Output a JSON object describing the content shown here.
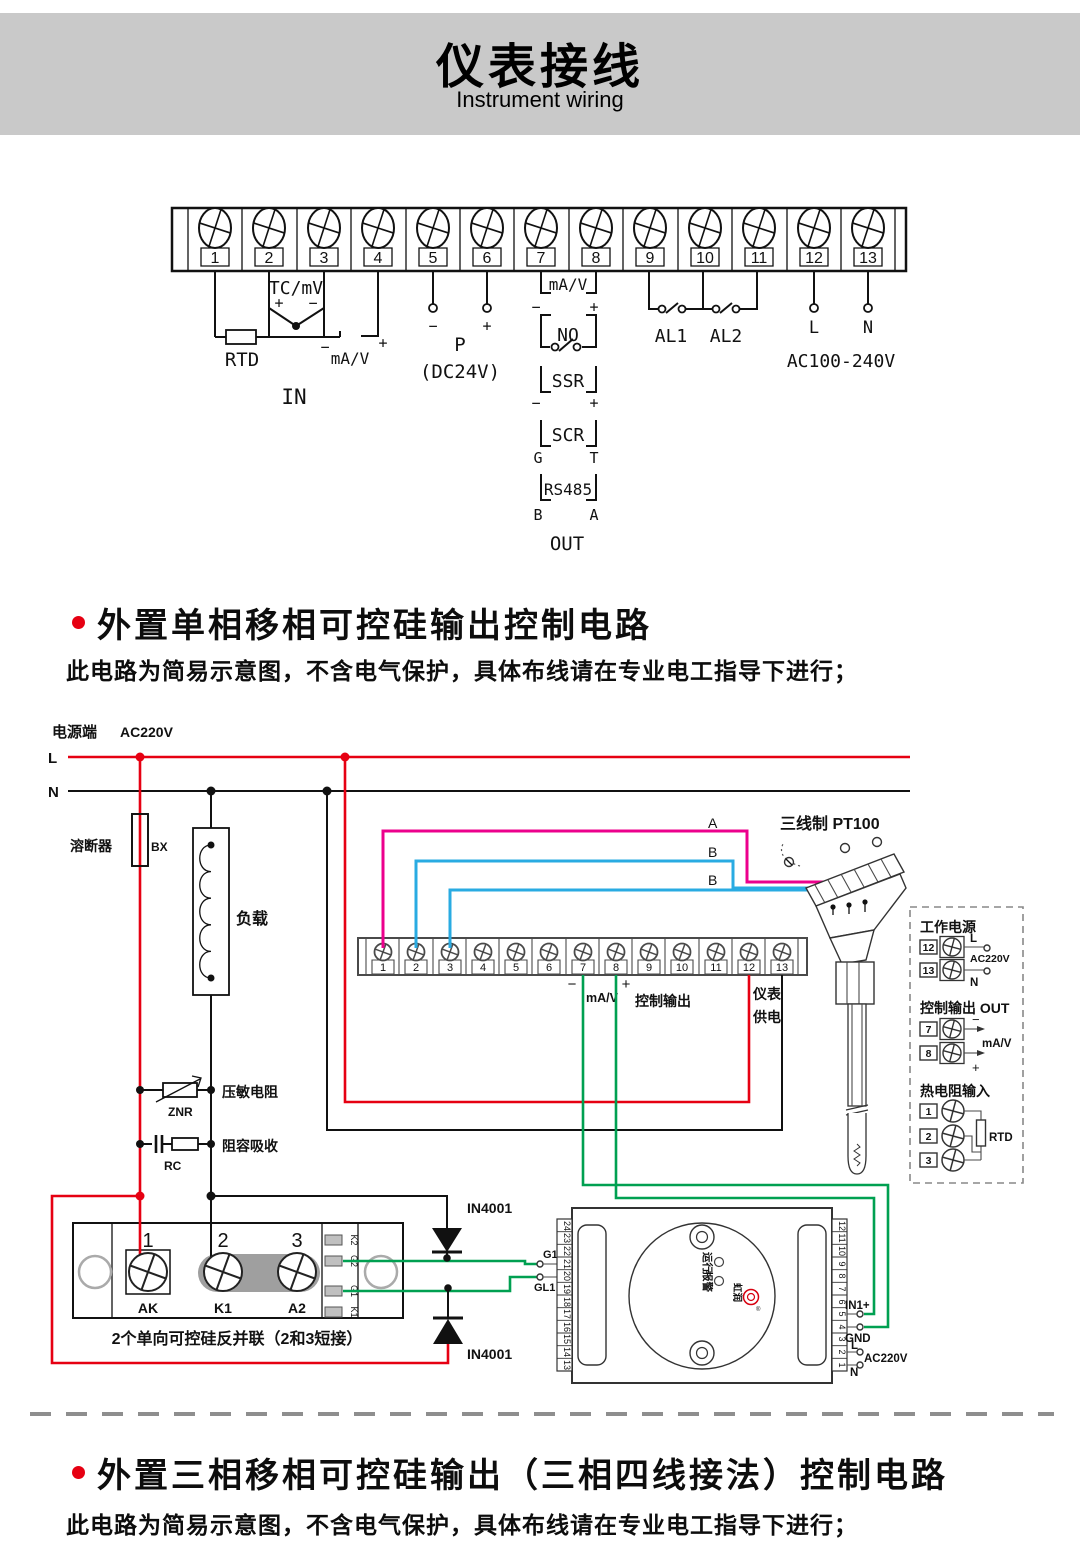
{
  "header": {
    "title": "仪表接线",
    "subtitle": "Instrument wiring"
  },
  "signs": {
    "minus": "−",
    "plus": "+"
  },
  "terminals": [
    "1",
    "2",
    "3",
    "4",
    "5",
    "6",
    "7",
    "8",
    "9",
    "10",
    "11",
    "12",
    "13"
  ],
  "top_diagram": {
    "tc_mv": "TC/mV",
    "rtd": "RTD",
    "in_ma_v": "mA/V",
    "in_label": "IN",
    "p": "P",
    "dc24v": "(DC24V)",
    "out_ma_v": "mA/V",
    "no": "NO",
    "ssr": "SSR",
    "scr": "SCR",
    "g": "G",
    "t": "T",
    "rs485": "RS485",
    "b": "B",
    "a": "A",
    "out": "OUT",
    "al1": "AL1",
    "al2": "AL2",
    "l": "L",
    "n": "N",
    "ac": "AC100-240V"
  },
  "section1": {
    "title": "外置单相移相可控硅输出控制电路",
    "note": "此电路为简易示意图，不含电气保护，具体布线请在专业电工指导下进行；"
  },
  "circuit": {
    "power_label": "电源端",
    "power_voltage": "AC220V",
    "l": "L",
    "n": "N",
    "fuse_label": "溶断器",
    "fuse_code": "BX",
    "load_label": "负载",
    "varistor_label": "压敏电阻",
    "varistor_code": "ZNR",
    "rc_label": "阻容吸收",
    "rc_code": "RC",
    "ma_v": "mA/V",
    "control_out": "控制输出",
    "supply1": "仪表",
    "supply2": "供电",
    "pt100_label": "三线制 PT100",
    "wire_a": "A",
    "wire_b1": "B",
    "wire_b2": "B",
    "diode1": "IN4001",
    "diode2": "IN4001",
    "scr_module": {
      "n1": "1",
      "n2": "2",
      "n3": "3",
      "ak": "AK",
      "k1": "K1",
      "a2": "A2",
      "tab_k2": "K2",
      "tab_g2": "G2",
      "tab_g1": "G1",
      "tab_k1": "K1",
      "caption": "2个单向可控硅反并联（2和3短接）"
    },
    "trigger": {
      "g1": "G1",
      "gl1": "GL1",
      "run": "运行",
      "alarm": "报警",
      "brand": "虹润",
      "reg": "®",
      "in1": "IN1+",
      "gnd": "GND",
      "l": "L",
      "ac": "AC220V",
      "n": "N"
    },
    "trigger_left": [
      "24",
      "23",
      "22",
      "21",
      "20",
      "19",
      "18",
      "17",
      "16",
      "15",
      "14",
      "13"
    ],
    "trigger_right": [
      "12",
      "11",
      "10",
      "9",
      "8",
      "7",
      "6",
      "5",
      "4",
      "3",
      "2",
      "1"
    ],
    "panel": {
      "power_title": "工作电源",
      "t12": "12",
      "t13": "13",
      "l": "L",
      "ac": "AC220V",
      "n": "N",
      "out_title": "控制输出 OUT",
      "t7": "7",
      "t8": "8",
      "ma_v": "mA/V",
      "rtd_title": "热电阻输入",
      "t1": "1",
      "t2": "2",
      "t3": "3",
      "rtd": "RTD"
    }
  },
  "section2": {
    "title": "外置三相移相可控硅输出（三相四线接法）控制电路",
    "note": "此电路为简易示意图，不含电气保护，具体布线请在专业电工指导下进行；"
  },
  "colors": {
    "accent_red": "#e60012",
    "wire_magenta": "#ec008c",
    "wire_blue": "#29abe2",
    "wire_green": "#00a051",
    "line": "#1a1a1a",
    "banner_gray": "#c9c9c9"
  }
}
